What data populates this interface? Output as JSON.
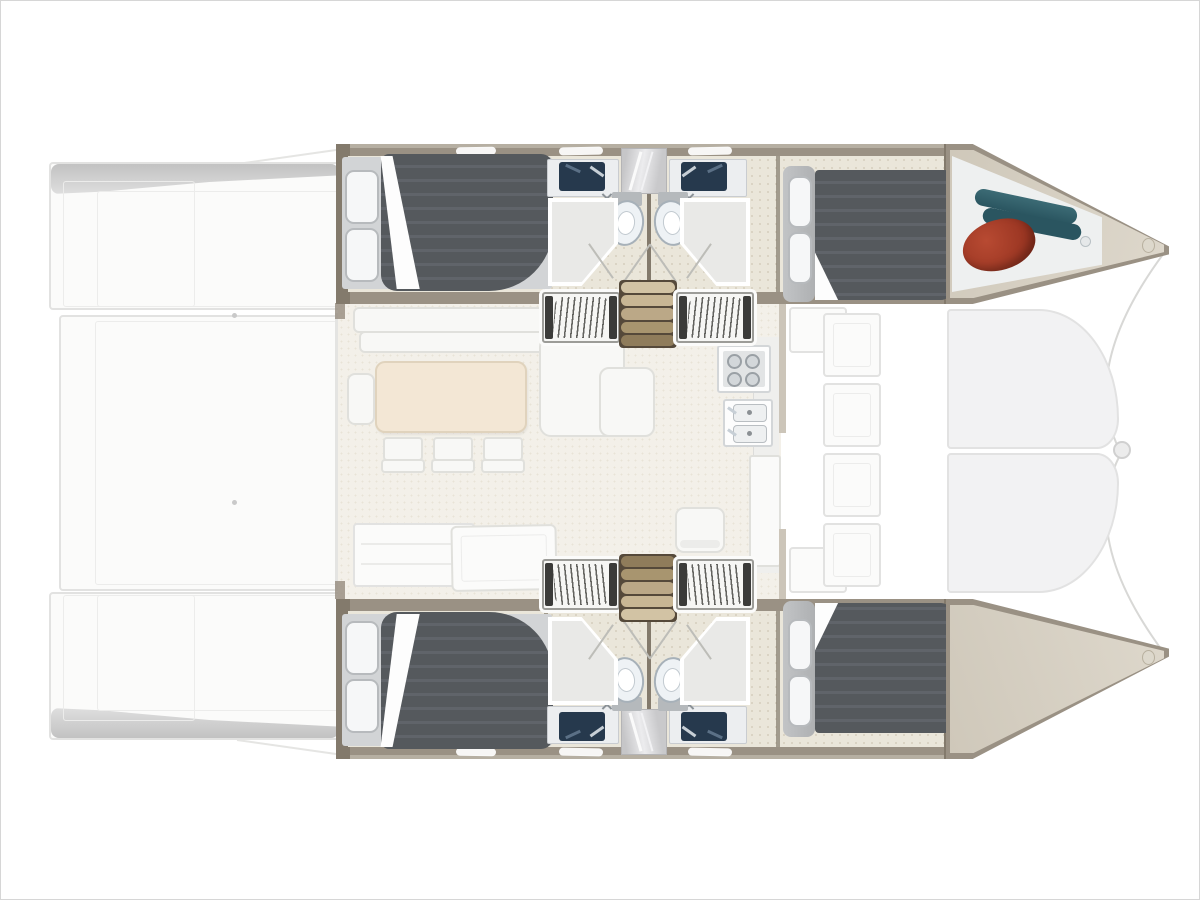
{
  "diagram": {
    "type": "floor-plan",
    "subject": "catamaran sailing yacht interior layout, top view",
    "orientation": {
      "bow": "right",
      "stern": "left"
    },
    "hulls": [
      {
        "name": "upper-hull",
        "rooms": [
          "aft double cabin with pillows and dark duvet",
          "bathroom with two navy sinks, mirror column, two toilets, two glass showers",
          "forward double cabin with headboard and two pillows",
          "bow locker holding a red fender and rolled teal gear"
        ]
      },
      {
        "name": "lower-hull",
        "rooms": [
          "aft double cabin with pillows and dark duvet",
          "bathroom with two navy sinks, mirror column, two toilets, two glass showers",
          "forward double cabin with headboard and two pillows",
          "empty bow locker with bow fitting"
        ]
      }
    ],
    "bridge_deck": {
      "salon": [
        "L-shaped sofa",
        "chaise seat",
        "dining table",
        "bench seat",
        "three chairs",
        "aft sofa",
        "chart desk",
        "single seat"
      ],
      "galley": [
        "stove with four burners",
        "double sink unit",
        "counter",
        "tall cabinet"
      ],
      "companionways": [
        "louvred step block left",
        "wooden staircase",
        "louvred step block right"
      ],
      "aft_cockpit": [
        "upper swim platform",
        "lower swim platform",
        "cockpit floor",
        "two deck dots"
      ],
      "forward_cockpit": [
        "panelled bench column",
        "upper seat",
        "lower seat"
      ],
      "foredeck": [
        "upper deck panel",
        "lower deck panel",
        "center bow fitting",
        "two bridle lines"
      ]
    },
    "object_colors": {
      "fender": "red",
      "rolled_gear": "teal"
    }
  },
  "colors": {
    "bg": "#ffffff",
    "frame": "#d6d6d6",
    "faint": "#e2e2e1",
    "faint_fill": "#fbfbfa",
    "shade": "#c6c6c6",
    "wall": "#9a9184",
    "wall_dark": "#837a6c",
    "wall_edge": "#b6afa2",
    "hull_floor": "#eae6da",
    "speckle": "#d9d2c2",
    "salon_floor": "#f3f0e9",
    "table_fill": "#f3e7d5",
    "table_edge": "#e0d3bd",
    "mattress": "#55595d",
    "mattress_hi": "#60646a",
    "sheet": "#d2d4d6",
    "pillow": "#f6f7f8",
    "pillow_edge": "#b7babd",
    "headboard": "#b9bbbd",
    "white_furn": "#f8f8f6",
    "furn_edge": "#e0e0dc",
    "toilet": "#eef2f5",
    "toilet_edge": "#a7b1b9",
    "navy": "#26394d",
    "steel": "#c7cfd6",
    "tan_dark": "#55493a",
    "rib_line": "#63635f",
    "rib_cap": "#3b3b39",
    "rib_frame": "#9c9c98",
    "red1": "#b84a32",
    "red2": "#8c2c1b",
    "teal1": "#3c6b75",
    "teal2": "#2a5560",
    "bow_inner": "#cfc8ba",
    "bow_store": "#eef0f0"
  }
}
